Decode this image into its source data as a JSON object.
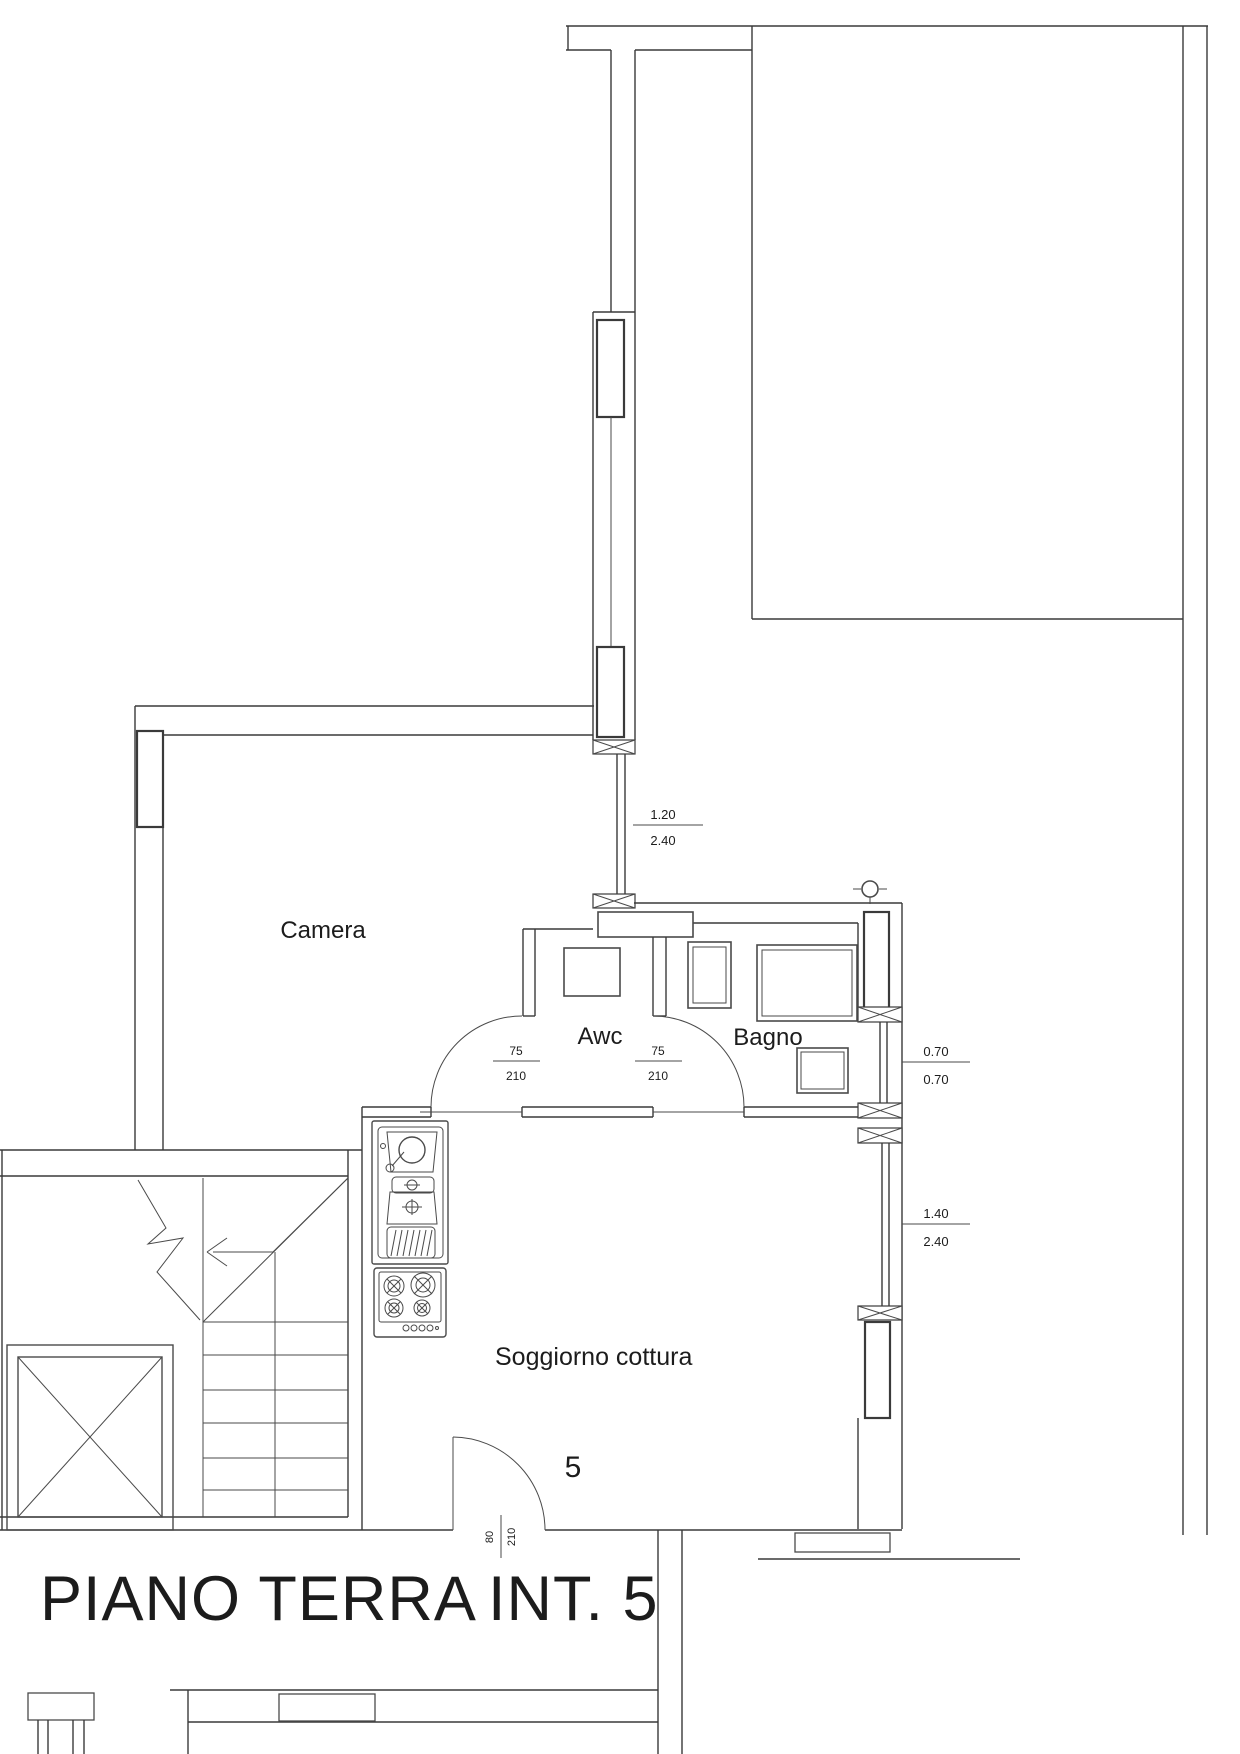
{
  "rooms": {
    "camera": "Camera",
    "awc": "Awc",
    "bagno": "Bagno",
    "soggiorno": "Soggiorno cottura"
  },
  "unit": {
    "number": "5"
  },
  "title": {
    "floor": "PIANO TERRA",
    "interior": "INT. 5"
  },
  "dimensions": {
    "french_window": {
      "width": "1.20",
      "height": "2.40"
    },
    "awc_door_left": {
      "width": "75",
      "height": "210"
    },
    "awc_door_right": {
      "width": "75",
      "height": "210"
    },
    "bagno_window": {
      "width": "0.70",
      "height": "0.70"
    },
    "soggiorno_window": {
      "width": "1.40",
      "height": "2.40"
    },
    "entrance_door": {
      "width": "80",
      "height": "210"
    }
  },
  "colors": {
    "line": "#3a3a3a",
    "text": "#1c1c1c"
  }
}
